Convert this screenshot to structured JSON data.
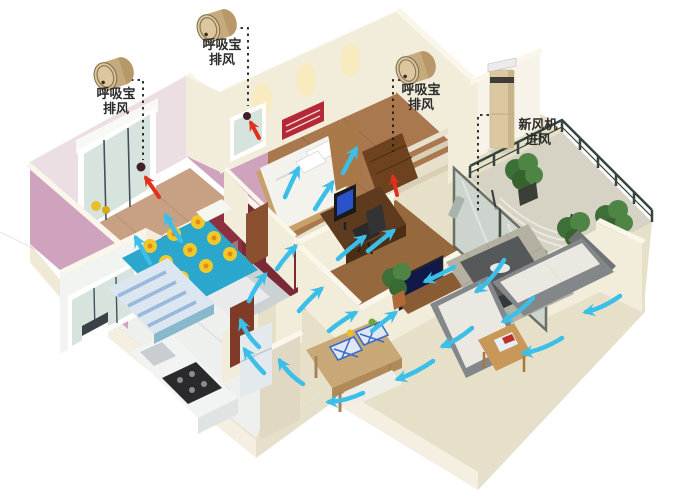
{
  "background": "#ffffff",
  "colors": {
    "background": "#ffffff",
    "arrow": "#3bbfe8",
    "accent-red": "#e0301e",
    "wall-cream": "#f2ecdb",
    "wall-cream-side": "#e0d8c2",
    "wall-pink": "#cfa2bd",
    "wall-maroon": "#8d3040",
    "device-gold": "#dcc69e",
    "tower-beige": "#dcc8a0",
    "floor-wood": "#c8a184",
    "floor-tile": "#e7e0c9",
    "label-text": "#2b2b2b"
  },
  "annotations": {
    "exhaust_units": [
      {
        "device": "呼吸宝",
        "mode": "排风"
      },
      {
        "device": "呼吸宝",
        "mode": "排风"
      },
      {
        "device": "呼吸宝",
        "mode": "排风"
      }
    ],
    "fresh_air_unit": {
      "device": "新风机",
      "mode": "进风"
    }
  }
}
